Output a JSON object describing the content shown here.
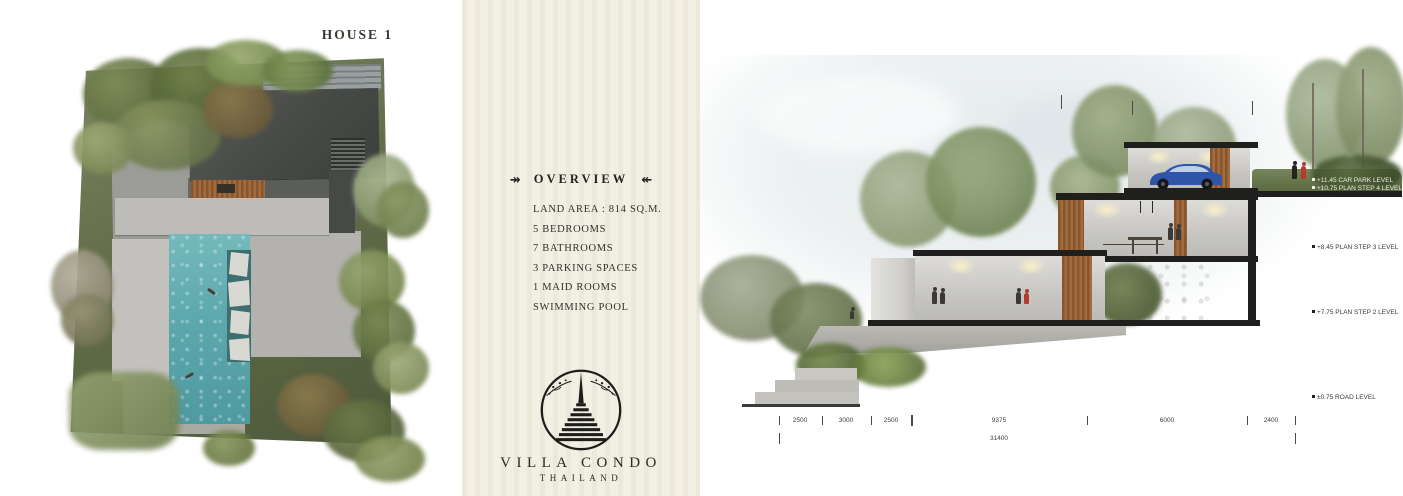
{
  "title": "HOUSE 1",
  "overview": {
    "heading": "OVERVIEW",
    "ornament_left": "↠",
    "ornament_right": "↞",
    "specs": [
      "LAND AREA : 814 SQ.M.",
      "5 BEDROOMS",
      "7 BATHROOMS",
      "3 PARKING SPACES",
      "1 MAID ROOMS",
      "SWIMMING POOL"
    ]
  },
  "brand": {
    "name": "VILLA CONDO",
    "country": "THAILAND"
  },
  "section_drawing": {
    "levels": [
      "+11.45 CAR PARK LEVEL",
      "+10.75 PLAN STEP 4 LEVEL",
      "+8.45 PLAN STEP 3 LEVEL",
      "+7.75 PLAN STEP 2 LEVEL",
      "±0.75 ROAD LEVEL"
    ],
    "dimensions": {
      "segments": [
        "2500",
        "3000",
        "2500",
        "9375",
        "6000",
        "2400"
      ],
      "total": "31400"
    }
  },
  "colors": {
    "band_cream": "#f2efe3",
    "pool_teal": "#5ca8ad",
    "roof_charcoal": "#434543",
    "car_blue": "#2f55a8",
    "accent_red": "#b53a2c",
    "ink": "#2e2c29"
  }
}
